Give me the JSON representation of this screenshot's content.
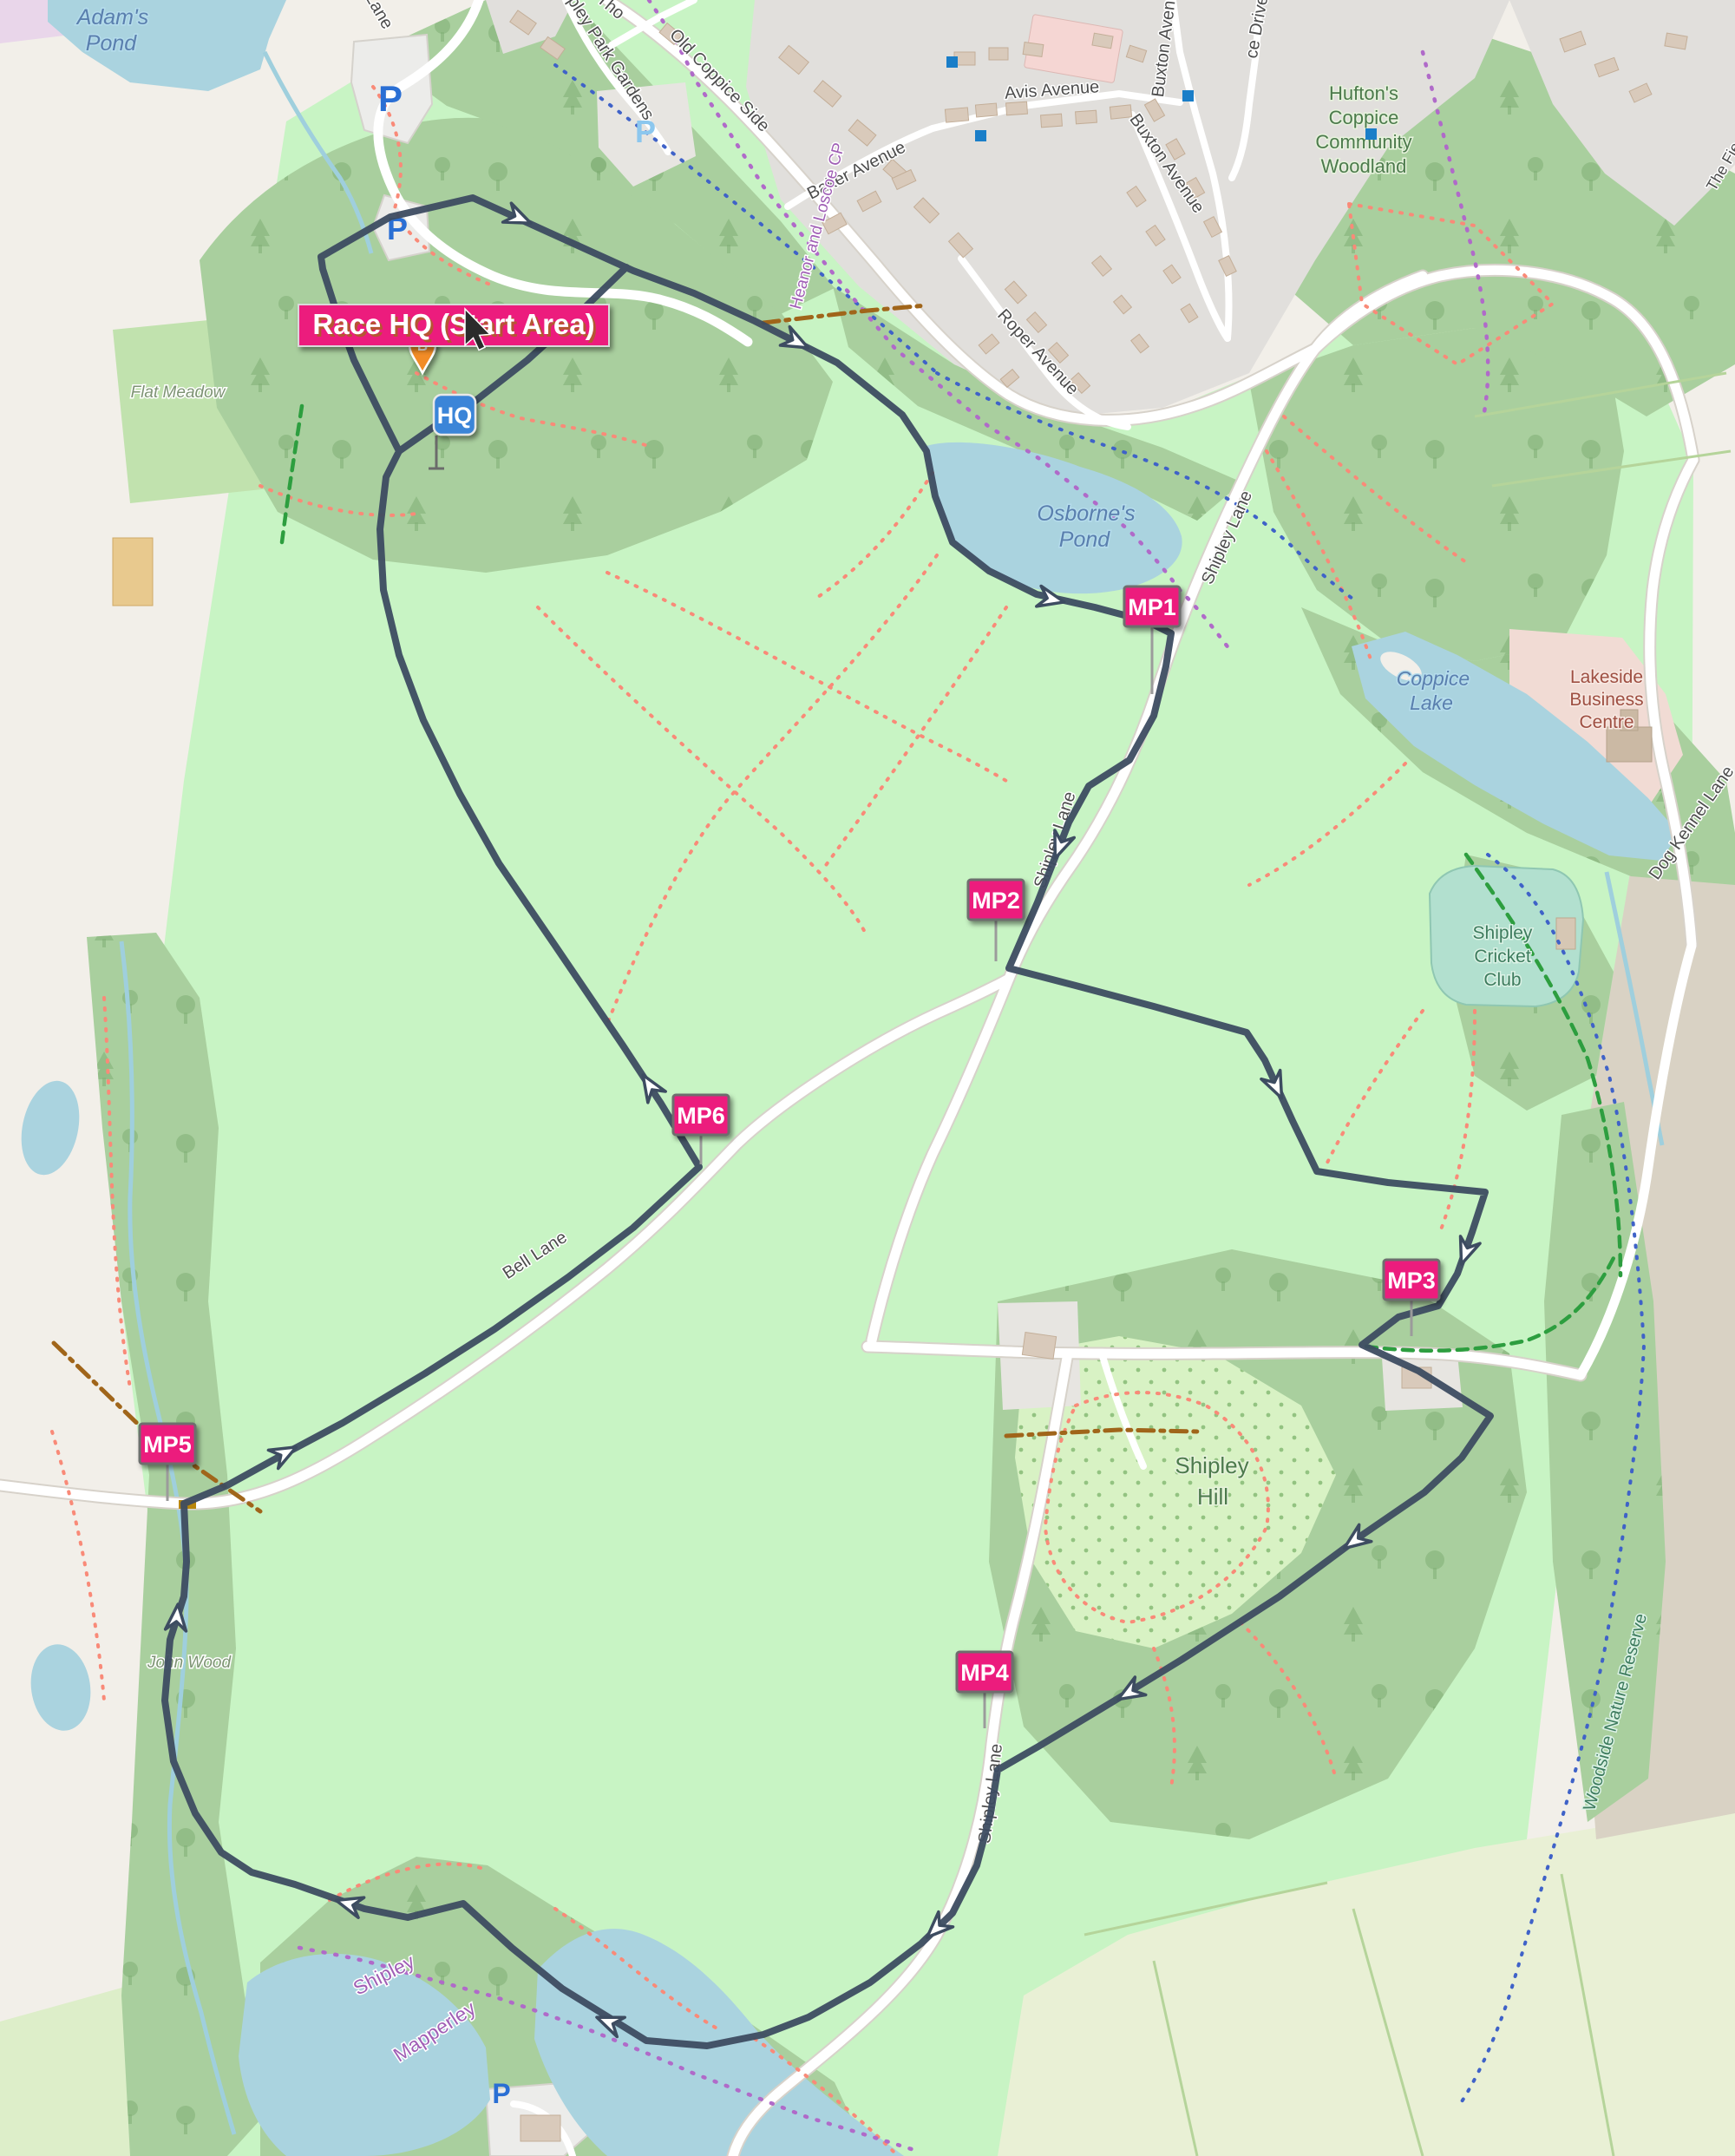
{
  "map": {
    "overlay": {
      "race_hq_label": "Race HQ (Start Area)",
      "hq_icon": "HQ",
      "start_pin": "B",
      "parking_icon": "P",
      "markers": [
        {
          "label": "MP1"
        },
        {
          "label": "MP2"
        },
        {
          "label": "MP3"
        },
        {
          "label": "MP4"
        },
        {
          "label": "MP5"
        },
        {
          "label": "MP6"
        }
      ]
    },
    "places": {
      "adams_pond_l1": "Adam's",
      "adams_pond_l2": "Pond",
      "osbornes_pond_l1": "Osborne's",
      "osbornes_pond_l2": "Pond",
      "coppice_lake_l1": "Coppice",
      "coppice_lake_l2": "Lake",
      "lakeside_l1": "Lakeside",
      "lakeside_l2": "Business",
      "lakeside_l3": "Centre",
      "cricket_l1": "Shipley",
      "cricket_l2": "Cricket",
      "cricket_l3": "Club",
      "huftons_l1": "Hufton's",
      "huftons_l2": "Coppice",
      "huftons_l3": "Community",
      "huftons_l4": "Woodland",
      "shipley_hill_l1": "Shipley",
      "shipley_hill_l2": "Hill",
      "flat_meadow": "Flat Meadow",
      "john_wood": "John Wood",
      "shipley_cp": "Shipley",
      "mapperley_cp": "Mapperley",
      "heanor_cp": "Heanor and Loscoe CP",
      "woodside": "Woodside Nature Reserve",
      "the_field_fragment": "The Fie"
    },
    "streets": {
      "shipley_park_gardens": "Shipley Park Gardens",
      "old_coppice_side": "Old Coppice Side",
      "thorpe_fragment": "Tho",
      "slack_fragment": "Slack Lane",
      "avis_avenue": "Avis Avenue",
      "baker_avenue": "Baker Avenue",
      "buxton_avenue": "Buxton Avenue",
      "roper_avenue": "Roper Avenue",
      "ce_drive_fragment": "ce Drive",
      "shipley_lane": "Shipley Lane",
      "bell_lane": "Bell Lane",
      "dog_kennel_lane": "Dog Kennel Lane"
    },
    "colors": {
      "route": "#3d4c61",
      "marker_pink": "#ec1a7d",
      "water": "#aad3df",
      "woodland": "#a9cf9e",
      "park": "#c8f4c4",
      "residential": "#e1dfdc",
      "hq_blue": "#3a85d8",
      "pin_orange": "#f28c28"
    }
  }
}
